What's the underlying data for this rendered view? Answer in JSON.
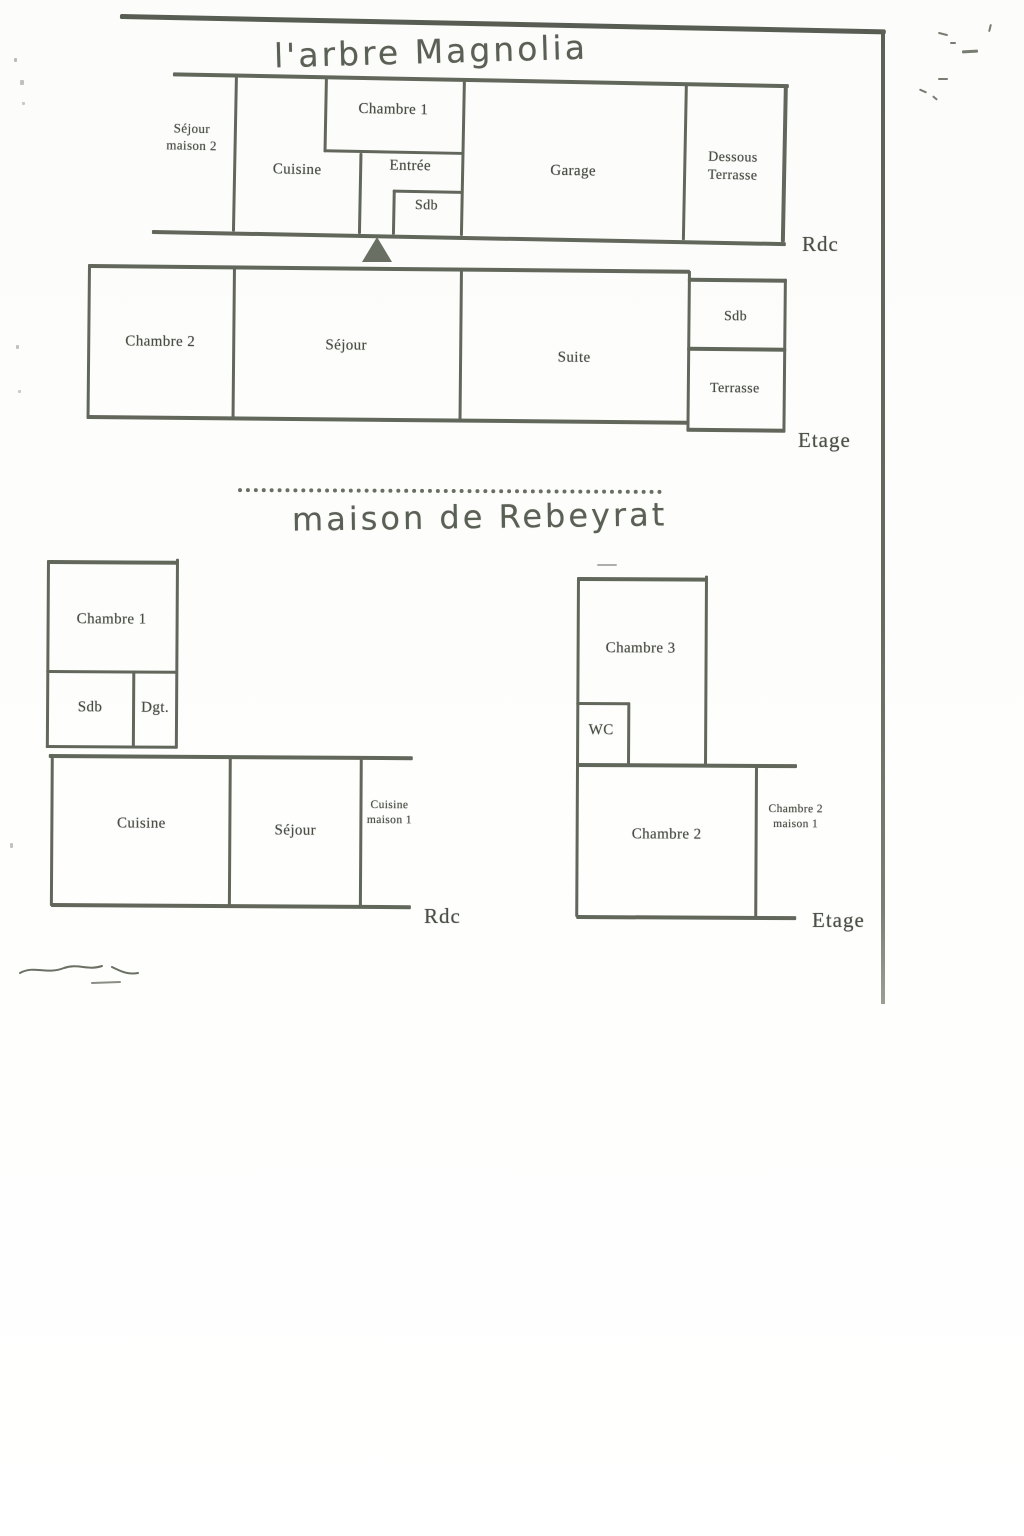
{
  "titles": {
    "magnolia": "l'arbre Magnolia",
    "rebeyrat": "maison de Rebeyrat"
  },
  "magnolia": {
    "rdc": {
      "floor_label": "Rdc",
      "rooms": {
        "sejour_maison2": "Séjour maison 2",
        "cuisine": "Cuisine",
        "chambre1": "Chambre 1",
        "entree": "Entrée",
        "sdb": "Sdb",
        "garage": "Garage",
        "dessous_terrasse": "Dessous Terrasse"
      }
    },
    "etage": {
      "floor_label": "Etage",
      "rooms": {
        "chambre2": "Chambre 2",
        "sejour": "Séjour",
        "suite": "Suite",
        "sdb": "Sdb",
        "terrasse": "Terrasse"
      }
    }
  },
  "rebeyrat": {
    "rdc": {
      "floor_label": "Rdc",
      "rooms": {
        "chambre1": "Chambre 1",
        "sdb": "Sdb",
        "dgt": "Dgt.",
        "cuisine": "Cuisine",
        "sejour": "Séjour",
        "cuisine_maison1": "Cuisine maison 1"
      }
    },
    "etage": {
      "floor_label": "Etage",
      "rooms": {
        "chambre3": "Chambre 3",
        "wc": "WC",
        "chambre2": "Chambre 2",
        "chambre2_maison1": "Chambre 2 maison 1"
      }
    }
  },
  "colors": {
    "line": "#62675c",
    "text": "#494e45",
    "handwriting": "#5b6056"
  }
}
